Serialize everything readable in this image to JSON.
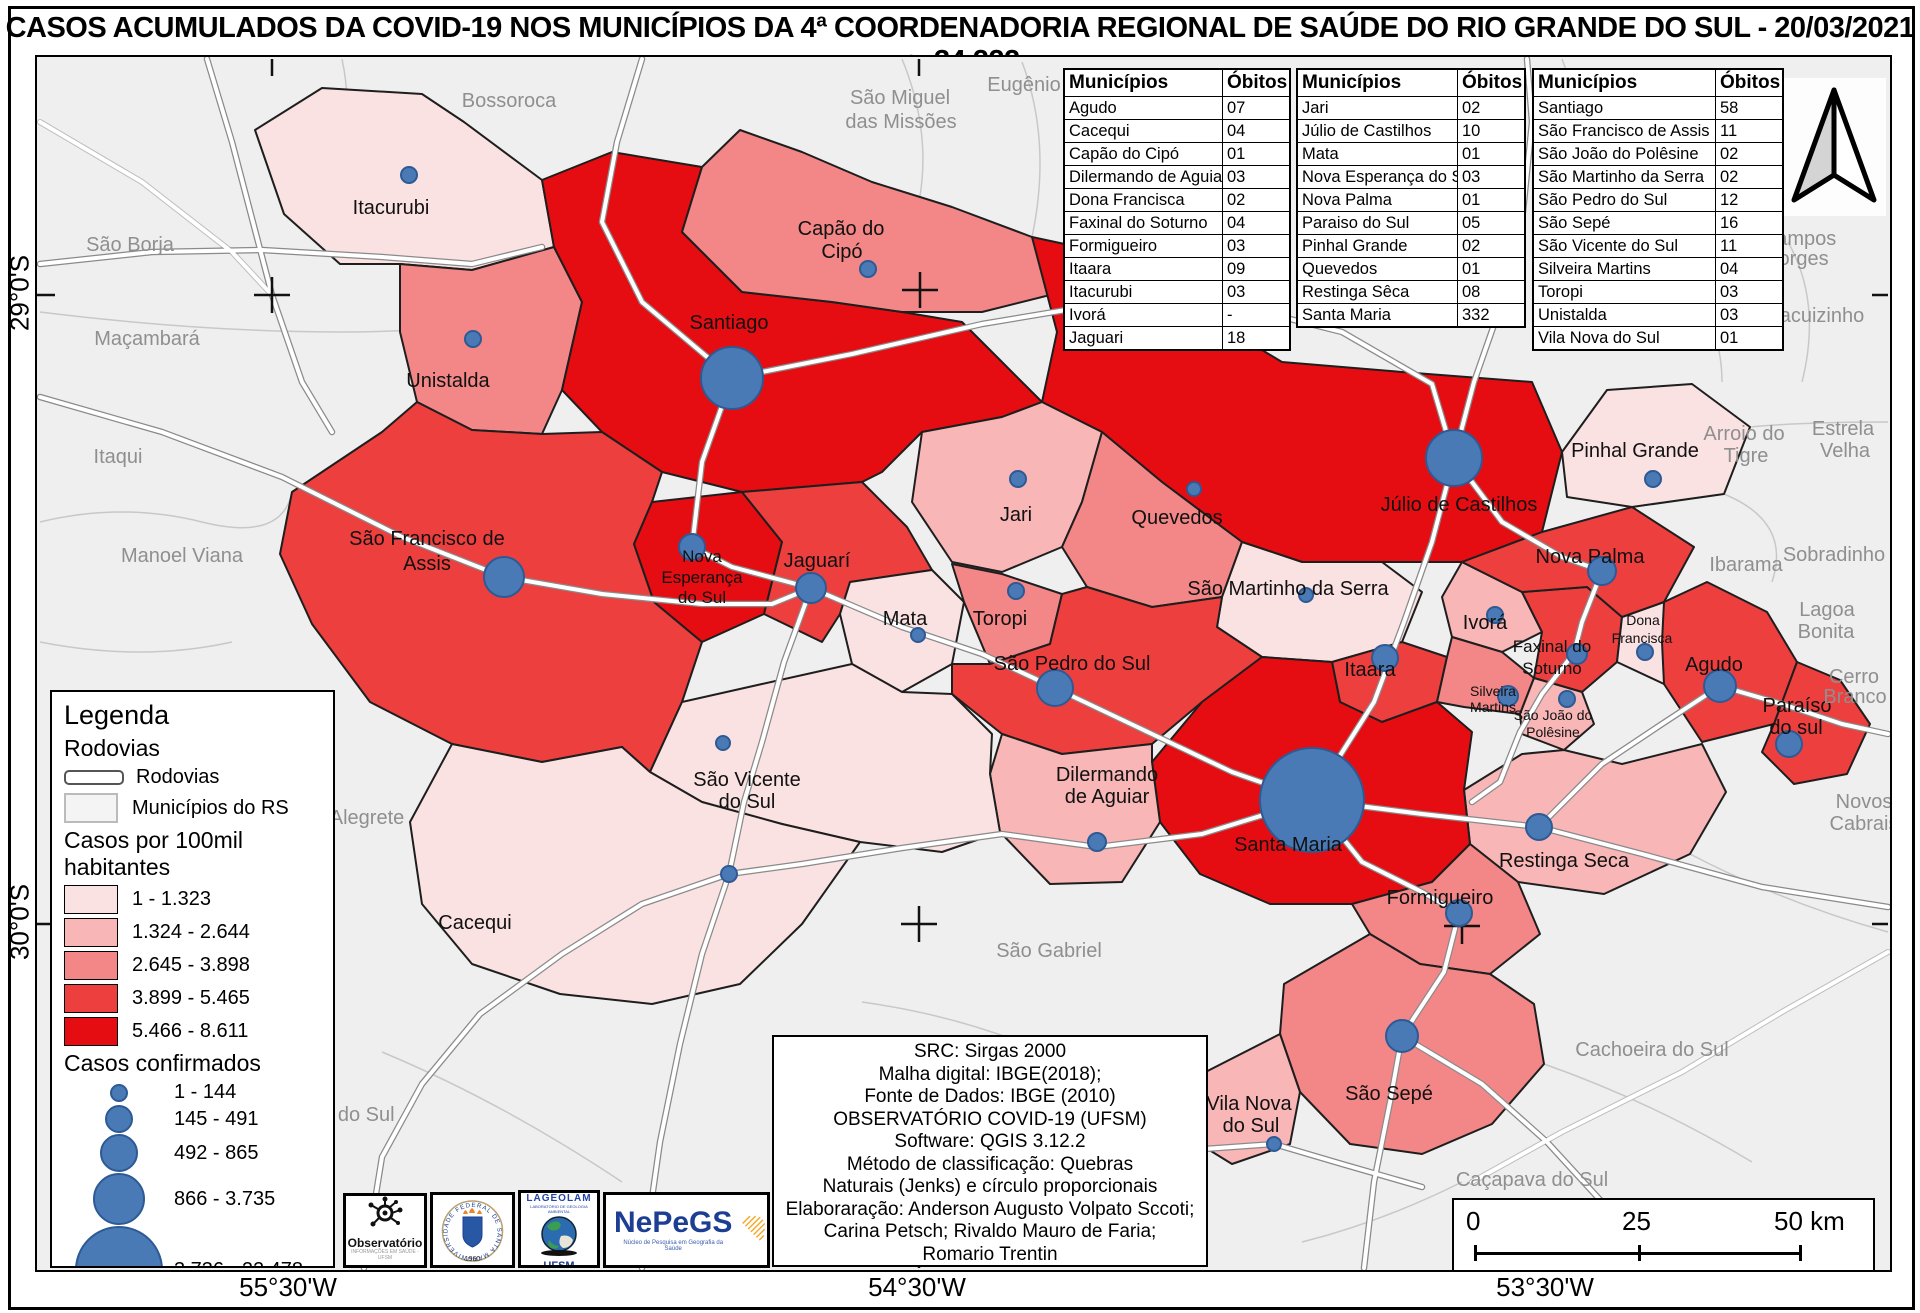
{
  "title": "CASOS ACUMULADOS DA COVID-19 NOS MUNICÍPIOS DA 4ª COORDENADORIA REGIONAL DE SAÚDE DO RIO GRANDE DO SUL - 20/03/2021 n=34.222",
  "tables": [
    {
      "headers": [
        "Municípios",
        "Óbitos"
      ],
      "rows": [
        [
          "Agudo",
          "07"
        ],
        [
          "Cacequi",
          "04"
        ],
        [
          "Capão do Cipó",
          "01"
        ],
        [
          "Dilermando de Aguiar",
          "03"
        ],
        [
          "Dona Francisca",
          "02"
        ],
        [
          "Faxinal do Soturno",
          "04"
        ],
        [
          "Formigueiro",
          "03"
        ],
        [
          "Itaara",
          "09"
        ],
        [
          "Itacurubi",
          "03"
        ],
        [
          "Ivorá",
          "-"
        ],
        [
          "Jaguari",
          "18"
        ]
      ]
    },
    {
      "headers": [
        "Municípios",
        "Óbitos"
      ],
      "rows": [
        [
          "Jari",
          "02"
        ],
        [
          "Júlio de Castilhos",
          "10"
        ],
        [
          "Mata",
          "01"
        ],
        [
          "Nova Esperança do Sul",
          "03"
        ],
        [
          "Nova Palma",
          "01"
        ],
        [
          "Paraiso do Sul",
          "05"
        ],
        [
          "Pinhal Grande",
          "02"
        ],
        [
          "Quevedos",
          "01"
        ],
        [
          "Restinga Sêca",
          "08"
        ],
        [
          "Santa Maria",
          "332"
        ]
      ]
    },
    {
      "headers": [
        "Municípios",
        "Óbitos"
      ],
      "rows": [
        [
          "Santiago",
          "58"
        ],
        [
          "São Francisco de Assis",
          "11"
        ],
        [
          "São João do Polêsine",
          "02"
        ],
        [
          "São Martinho da Serra",
          "02"
        ],
        [
          "São Pedro do Sul",
          "12"
        ],
        [
          "São Sepé",
          "16"
        ],
        [
          "São Vicente do Sul",
          "11"
        ],
        [
          "Silveira Martins",
          "04"
        ],
        [
          "Toropi",
          "03"
        ],
        [
          "Unistalda",
          "03"
        ],
        [
          "Vila Nova do Sul",
          "01"
        ]
      ]
    }
  ],
  "legend": {
    "title": "Legenda",
    "section_rodovias": "Rodovias",
    "item_rodovias": "Rodovias",
    "item_municipios": "Municípios do RS",
    "section_choropleth": "Casos por 100mil habitantes",
    "choropleth_classes": [
      {
        "label": "1 - 1.323",
        "color": "#fbe2e2"
      },
      {
        "label": "1.324 - 2.644",
        "color": "#f8b6b6"
      },
      {
        "label": "2.645 - 3.898",
        "color": "#f38686"
      },
      {
        "label": "3.899 - 5.465",
        "color": "#ee3f3f"
      },
      {
        "label": "5.466 - 8.611",
        "color": "#e60d12"
      }
    ],
    "section_circles": "Casos confirmados",
    "circle_classes": [
      {
        "label": "1 - 144",
        "d": 18
      },
      {
        "label": "145 - 491",
        "d": 28
      },
      {
        "label": "492 - 865",
        "d": 38
      },
      {
        "label": "866 - 3.735",
        "d": 52
      },
      {
        "label": "3.736 - 22.478",
        "d": 88
      }
    ]
  },
  "map_labels": {
    "itacurubi": "Itacurubi",
    "unistalda": "Unistalda",
    "santiago": "Santiago",
    "capao": [
      "Capão do",
      "Cipó"
    ],
    "sfa": [
      "São Francisco de",
      "Assis"
    ],
    "novaesp": [
      "Nova",
      "Esperança",
      "do Sul"
    ],
    "jaguari": "Jaguarí",
    "jari": "Jari",
    "quevedos": "Quevedos",
    "julio": "Júlio de Castilhos",
    "pinhal": "Pinhal Grande",
    "novapalma": "Nova Palma",
    "smartinho": "São Martinho da Serra",
    "itaara": "Itaara",
    "ivora": "Ivorá",
    "faxinal": [
      "Faxinal do",
      "Soturno"
    ],
    "silveira": [
      "Silveira",
      "Martins"
    ],
    "sjpolesine": [
      "São João do",
      "Polêsine"
    ],
    "dfrancisca": [
      "Dona",
      "Francisca"
    ],
    "agudo": "Agudo",
    "paraiso": [
      "Paraíso",
      "do sul"
    ],
    "mata": "Mata",
    "toropi": "Toropi",
    "sps": "São Pedro do Sul",
    "svicente": [
      "São Vicente",
      "do Sul"
    ],
    "dilermando": [
      "Dilermando",
      "de Aguiar"
    ],
    "cacequi": "Cacequi",
    "santamaria": "Santa Maria",
    "restinga": "Restinga Seca",
    "formigueiro": "Formigueiro",
    "saosepe": "São Sepé",
    "vilanova": [
      "Vila Nova",
      "do Sul"
    ]
  },
  "neighbor_labels": {
    "bossoroca": "Bossoroca",
    "smm": [
      "São Miguel",
      "das Missões"
    ],
    "eugenio": "Eugênio",
    "saoborja": "São Borja",
    "macambara": "Maçambará",
    "itaqui": "Itaqui",
    "manoelviana": "Manoel Viana",
    "alegrete": "Alegrete",
    "rosario": "Rosário do Sul",
    "saogabriel": "São Gabriel",
    "camposborges": [
      "Campos",
      "borges"
    ],
    "jacuizinho": "Jacuizinho",
    "arroio": [
      "Arroio do",
      "Tigre"
    ],
    "estrela": [
      "Estrela",
      "Velha"
    ],
    "ibarama": "Ibarama",
    "sobradinho": "Sobradinho",
    "lagoa": [
      "Lagoa",
      "Bonita"
    ],
    "cerro": [
      "Cerro",
      "Branco"
    ],
    "novoscabrais": [
      "Novos",
      "Cabrais"
    ],
    "cachoeira": "Cachoeira do Sul",
    "cacapava": "Caçapava do Sul"
  },
  "coords": {
    "lat": [
      "29°0'S",
      "30°0'S"
    ],
    "lon": [
      "55°30'W",
      "54°30'W",
      "53°30'W"
    ]
  },
  "scalebar": {
    "zero": "0",
    "mid": "25",
    "end": "50 km"
  },
  "info_box": {
    "lines": [
      "SRC: Sirgas 2000",
      "Malha digital: IBGE(2018);",
      "Fonte de Dados: IBGE (2010)",
      "OBSERVATÓRIO COVID-19 (UFSM)",
      "Software: QGIS 3.12.2",
      "Método de classificação: Quebras",
      "Naturais (Jenks) e círculo proporcionais",
      "Elaboraração: Anderson Augusto Volpato Sccoti;",
      "Carina Petsch; Rivaldo Mauro de Faria;",
      "Romario Trentin"
    ]
  },
  "logos": {
    "observatorio": "Observatório",
    "observatorio_sub": "INFORMAÇÕES EM SAÚDE - UFSM",
    "ufsm_year": "1960",
    "ufsm_ring": "UNIVERSIDADE FEDERAL DE SANTA MARIA",
    "lageolam": "LAGEOLAM",
    "lageolam_sub": "LABORATÓRIO DE GEOLOGIA AMBIENTAL",
    "ufsm": "UFSM",
    "nepegs": "NePeGS",
    "nepegs_sub": "Núcleo de Pesquisa em Geografia da Saúde"
  },
  "colors": {
    "circle_fill": "#4a7ab5",
    "circle_stroke": "#2d5a94",
    "outside_fill": "#efefef",
    "outside_label": "#8f8f8f"
  }
}
